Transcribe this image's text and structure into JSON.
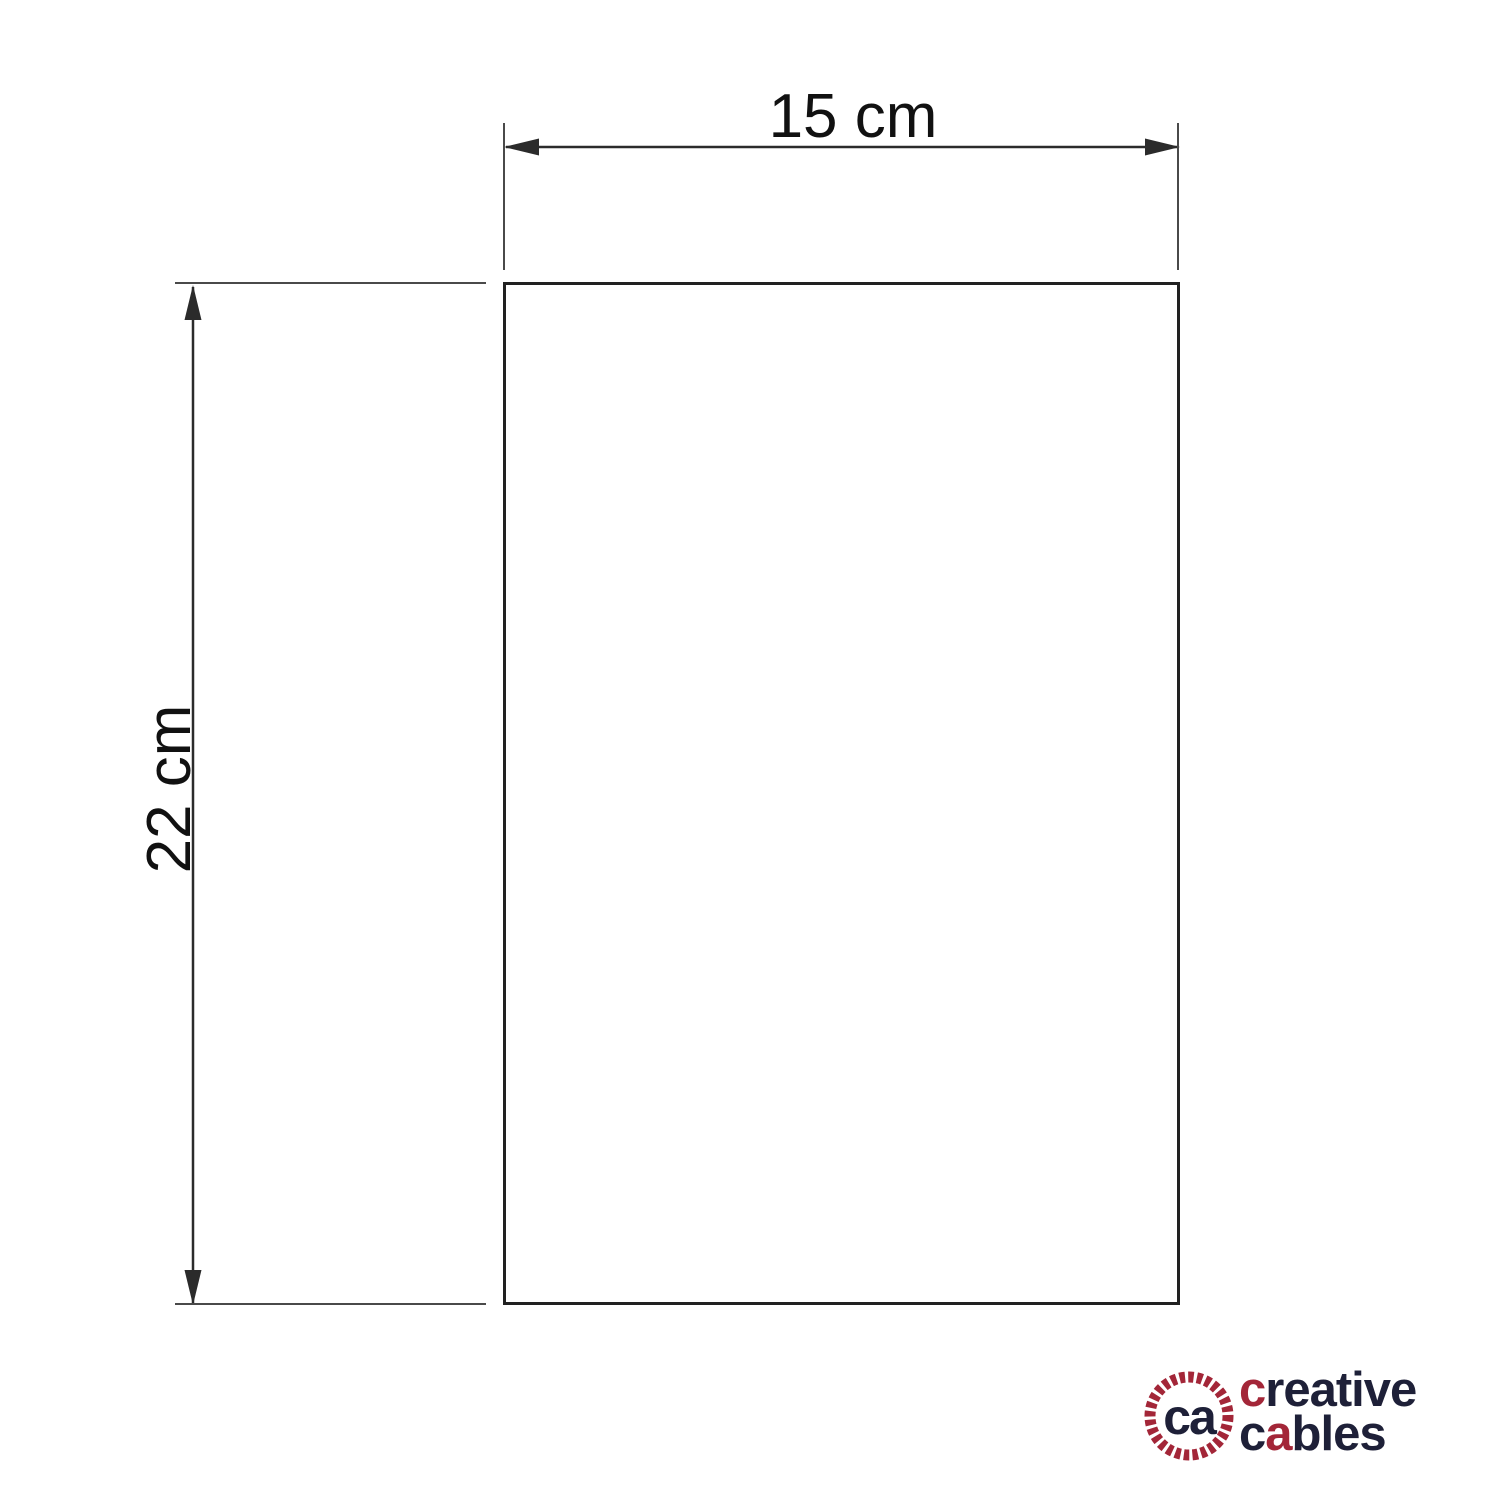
{
  "diagram": {
    "type": "product-dimension-drawing",
    "width_label": "15 cm",
    "height_label": "22 cm"
  },
  "logo": {
    "monogram": "ca",
    "creative_first": "c",
    "creative_rest": "reative",
    "cables_first": "c",
    "cables_second": "a",
    "cables_rest": "bles"
  },
  "colors": {
    "bg": "#ffffff",
    "line": "#2b2b2b",
    "ext-line": "#4a4a4a",
    "outline": "#212121",
    "dim-text": "#111111",
    "logo-dark": "#1e2038",
    "logo-red": "#a32638"
  }
}
